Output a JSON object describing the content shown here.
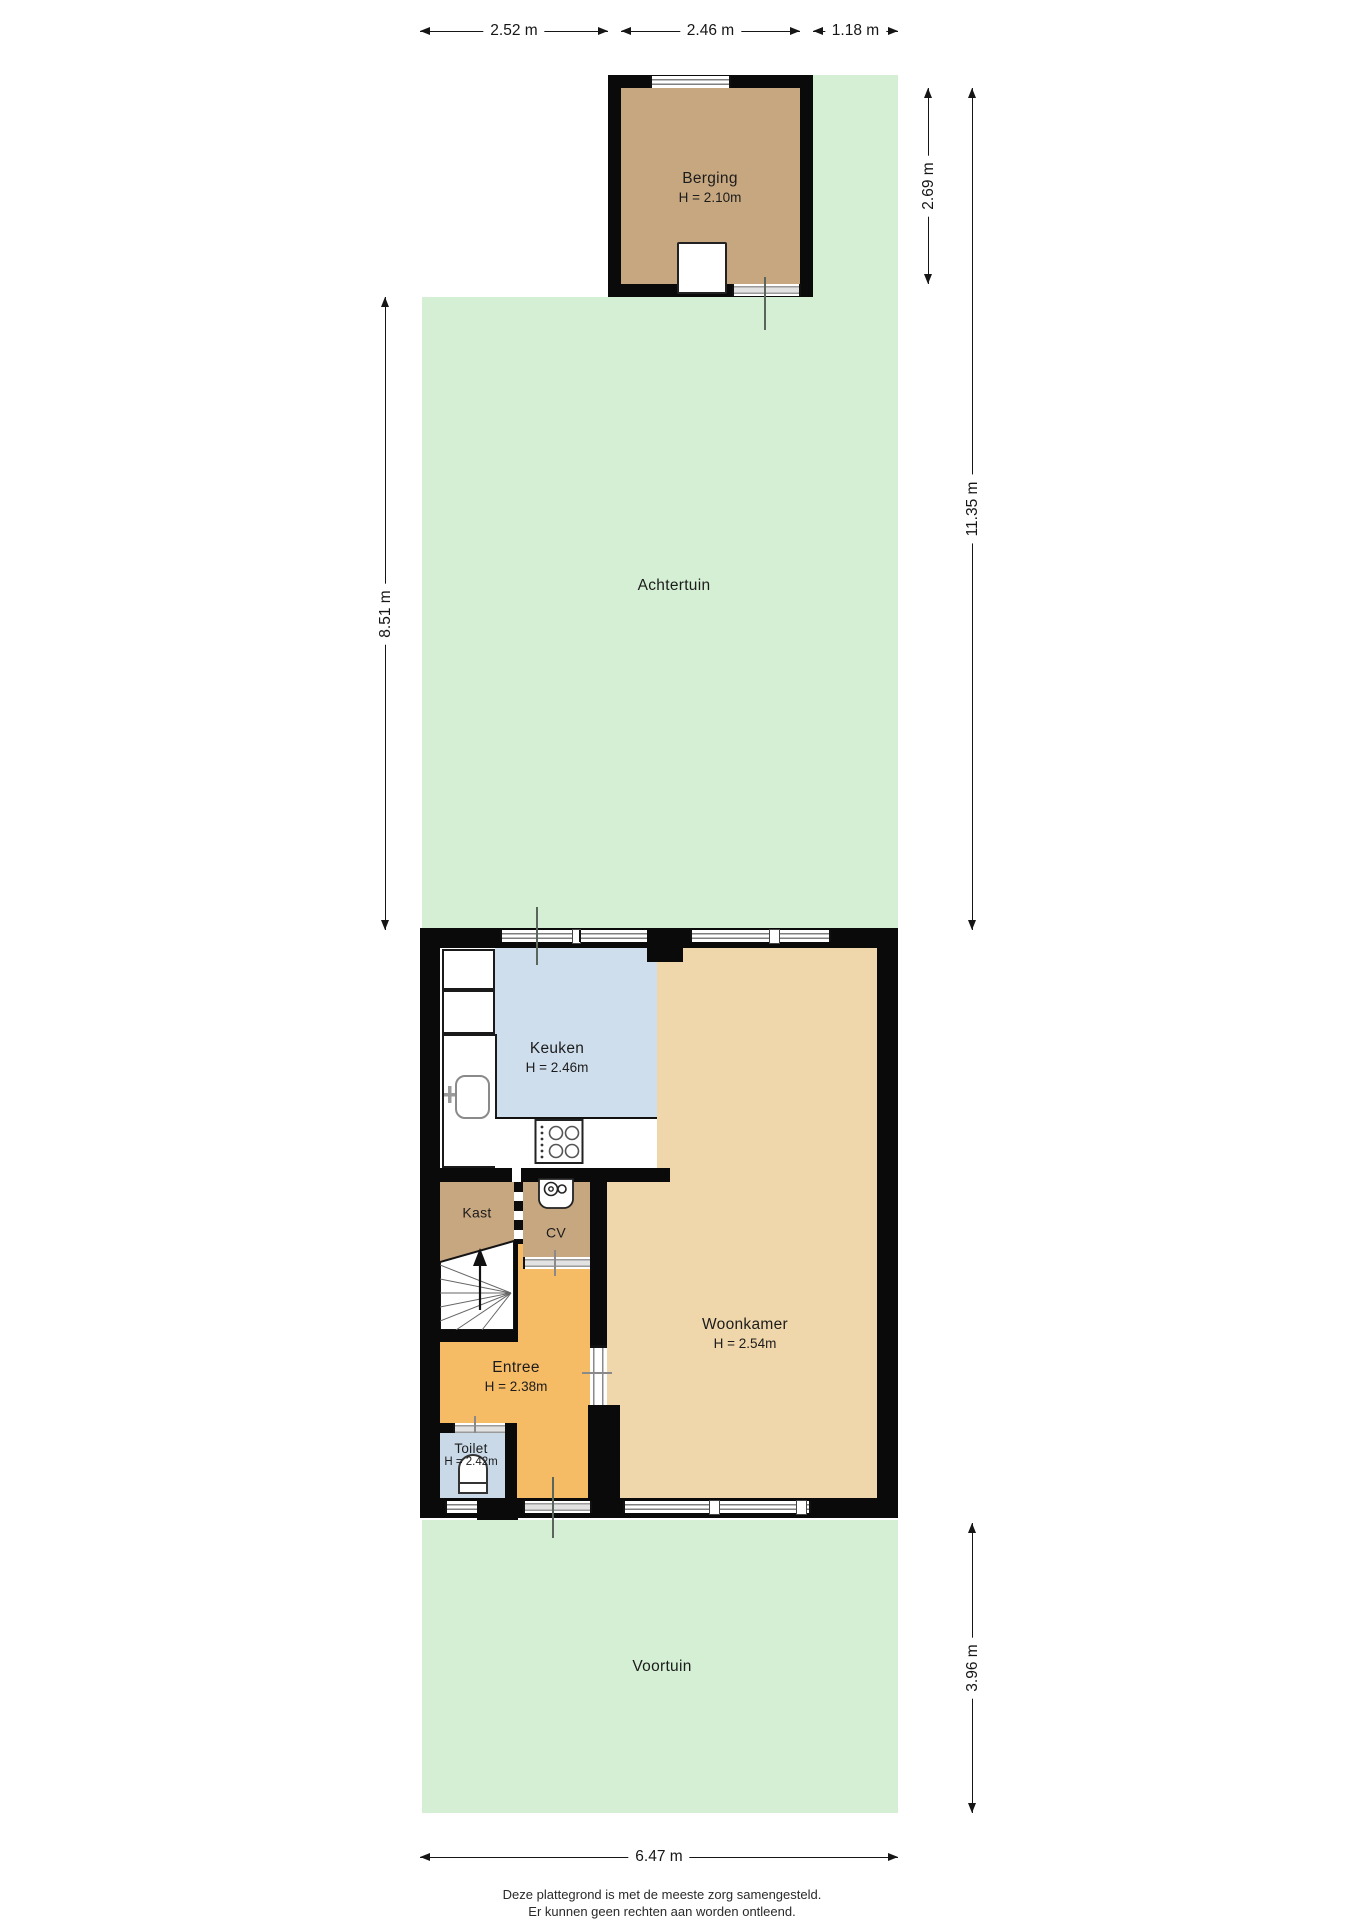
{
  "page": {
    "footer": [
      "Deze plattegrond is met de meeste zorg samengesteld.",
      "Er kunnen geen rechten aan worden ontleend."
    ]
  },
  "colors": {
    "garden": "#d4efd3",
    "outbuilding": "#c7a780",
    "living": "#efd7ab",
    "kitchen": "#cfdeed",
    "toilet": "#c9d9e8",
    "entree": "#f6bb65",
    "wall": "#0a0a0a"
  },
  "rooms": {
    "berging": {
      "name": "Berging",
      "height": "H = 2.10m"
    },
    "achtertuin": {
      "name": "Achtertuin"
    },
    "keuken": {
      "name": "Keuken",
      "height": "H = 2.46m"
    },
    "kast": {
      "name": "Kast"
    },
    "cv": {
      "name": "CV"
    },
    "woonkamer": {
      "name": "Woonkamer",
      "height": "H = 2.54m"
    },
    "entree": {
      "name": "Entree",
      "height": "H = 2.38m"
    },
    "toilet": {
      "name": "Toilet",
      "height": "H = 2.42m"
    },
    "voortuin": {
      "name": "Voortuin"
    }
  },
  "dimensions": {
    "top_left": "2.52 m",
    "top_middle": "2.46 m",
    "top_right": "1.18 m",
    "left": "8.51 m",
    "right_upper": "2.69 m",
    "right_full": "11.35 m",
    "right_lower": "3.96 m",
    "bottom": "6.47 m"
  }
}
